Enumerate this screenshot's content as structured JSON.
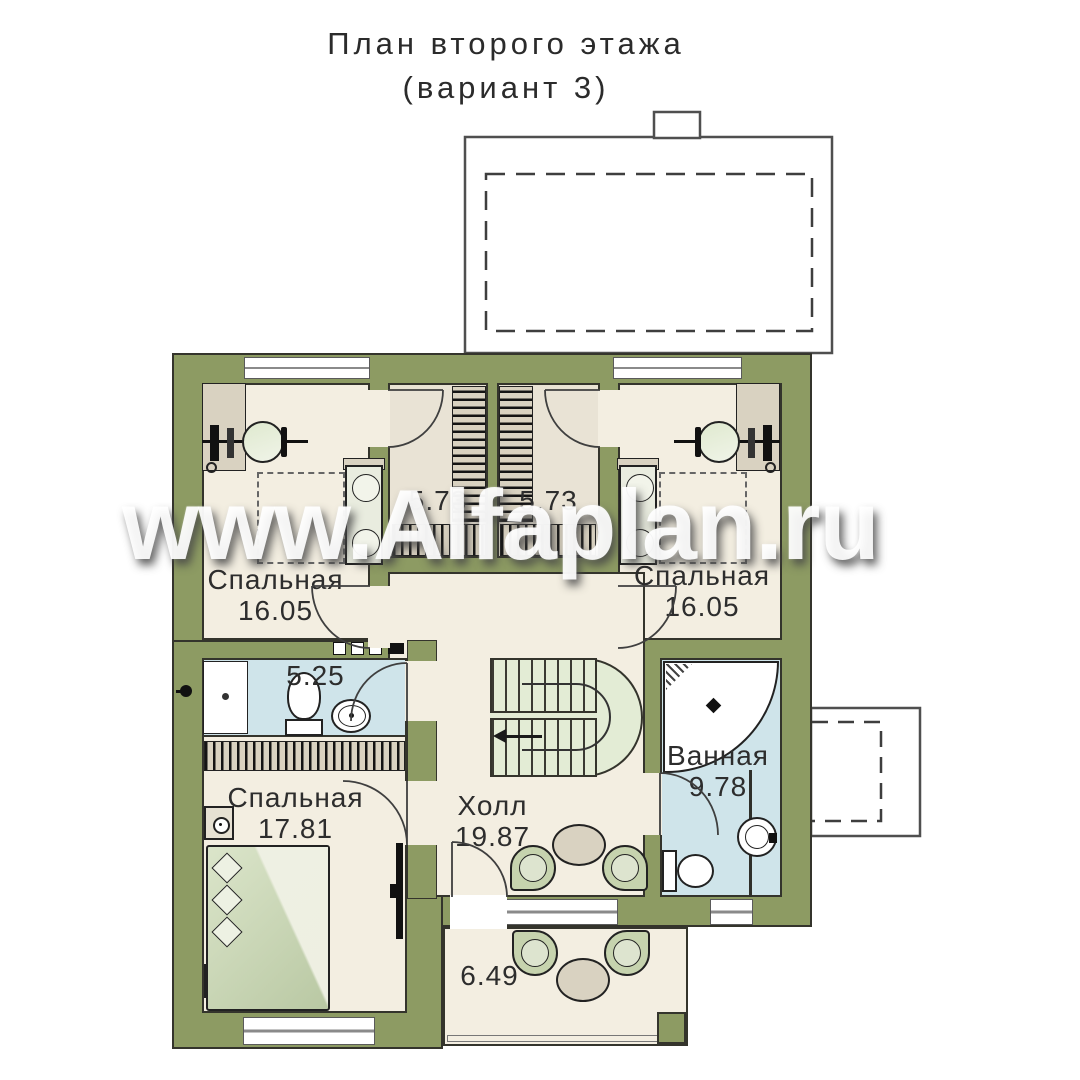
{
  "title": {
    "line1": "План второго этажа",
    "line2": "(вариант 3)"
  },
  "watermark": "www.Alfaplan.ru",
  "rooms": {
    "bedroom_tl": {
      "name": "Спальная",
      "area": "16.05"
    },
    "bedroom_tr": {
      "name": "Спальная",
      "area": "16.05"
    },
    "bedroom_bl": {
      "name": "Спальная",
      "area": "17.81"
    },
    "wardrobe_l": {
      "name": "",
      "area": "5.73"
    },
    "wardrobe_r": {
      "name": "",
      "area": "5.73"
    },
    "bathroom_small": {
      "name": "",
      "area": "5.25"
    },
    "bathroom_main": {
      "name": "Ванная",
      "area": "9.78"
    },
    "hall": {
      "name": "Холл",
      "area": "19.87"
    },
    "balcony": {
      "name": "",
      "area": "6.49"
    }
  },
  "colors": {
    "wall": "#8d9b63",
    "line": "#34342c",
    "floor": "#f3eee1",
    "wardrobe_floor": "#e9e3d5",
    "bath_floor": "#cfe4ea",
    "stairs": "#e3ecd5",
    "furn_green": "#c6d3ae",
    "furn_tan": "#d9d2c1"
  }
}
